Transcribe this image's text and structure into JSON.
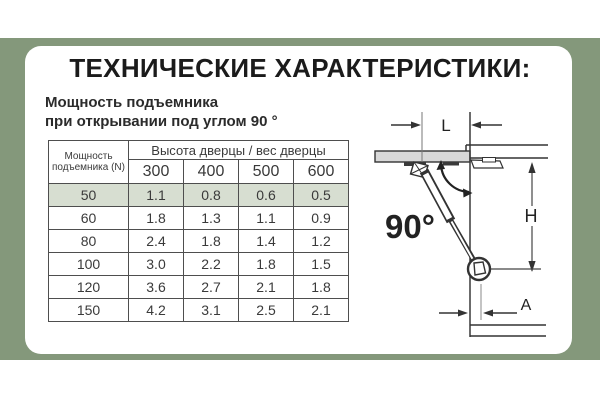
{
  "page": {
    "title": "ТЕХНИЧЕСКИЕ ХАРАКТЕРИСТИКИ:",
    "subtitle_line1": "Мощность подъемника",
    "subtitle_line2": "при открывании под углом 90 °"
  },
  "colors": {
    "band_green": "#84987b",
    "highlight_row": "#d7ded1",
    "table_border": "#4e4e4e",
    "door_fill": "#d8d8d8",
    "diagram_line": "#333333"
  },
  "table": {
    "corner_header": "Мощность подъемника (N)",
    "group_header": "Высота дверцы / вес дверцы",
    "column_headers": [
      "300",
      "400",
      "500",
      "600"
    ],
    "rows": [
      {
        "power": "50",
        "values": [
          "1.1",
          "0.8",
          "0.6",
          "0.5"
        ],
        "highlighted": true
      },
      {
        "power": "60",
        "values": [
          "1.8",
          "1.3",
          "1.1",
          "0.9"
        ],
        "highlighted": false
      },
      {
        "power": "80",
        "values": [
          "2.4",
          "1.8",
          "1.4",
          "1.2"
        ],
        "highlighted": false
      },
      {
        "power": "100",
        "values": [
          "3.0",
          "2.2",
          "1.8",
          "1.5"
        ],
        "highlighted": false
      },
      {
        "power": "120",
        "values": [
          "3.6",
          "2.7",
          "2.1",
          "1.8"
        ],
        "highlighted": false
      },
      {
        "power": "150",
        "values": [
          "4.2",
          "3.1",
          "2.5",
          "2.1"
        ],
        "highlighted": false
      }
    ]
  },
  "diagram": {
    "angle_label": "90°",
    "dim_l": "L",
    "dim_h": "H",
    "dim_a": "A"
  }
}
